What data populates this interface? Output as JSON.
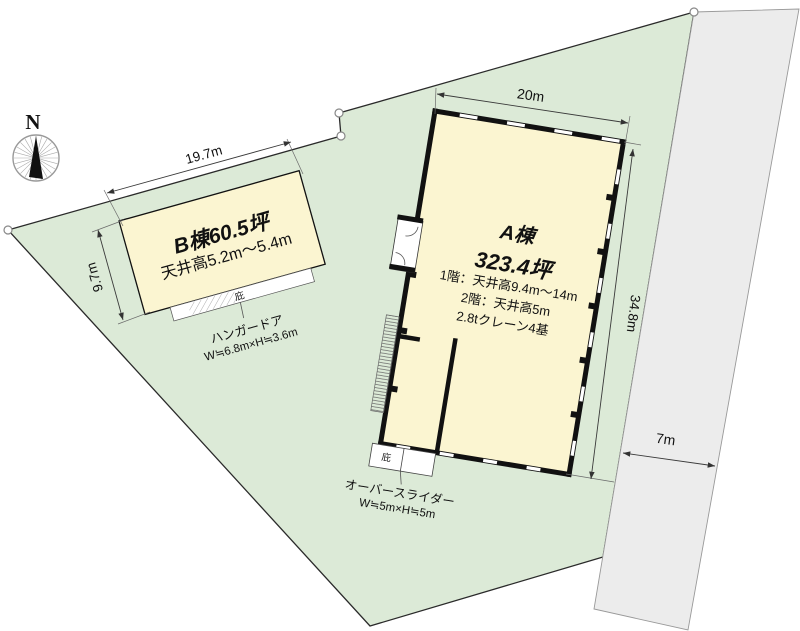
{
  "compass": {
    "north_label": "N"
  },
  "dimensions": {
    "b_width": "19.7m",
    "b_depth": "9.7m",
    "a_width": "20m",
    "a_depth": "34.8m",
    "road_width": "7m"
  },
  "building_b": {
    "title": "B棟60.5坪",
    "ceiling": "天井高5.2m～5.4m",
    "canopy_label": "庇",
    "door_label": "ハンガードア",
    "door_size": "W≒6.8m×H≒3.6m"
  },
  "building_a": {
    "title": "A棟",
    "area": "323.4坪",
    "spec_floor1": "1階：天井高9.4m～14m",
    "spec_floor2": "2階：天井高5m",
    "spec_crane": "2.8tクレーン4基",
    "canopy_label": "庇",
    "door_label": "オーバースライダー",
    "door_size": "W≒5m×H≒5m"
  },
  "colors": {
    "site_fill": "#dcead7",
    "building_fill": "#fbf5d1",
    "road_fill": "#ececec",
    "wall": "#111111"
  }
}
